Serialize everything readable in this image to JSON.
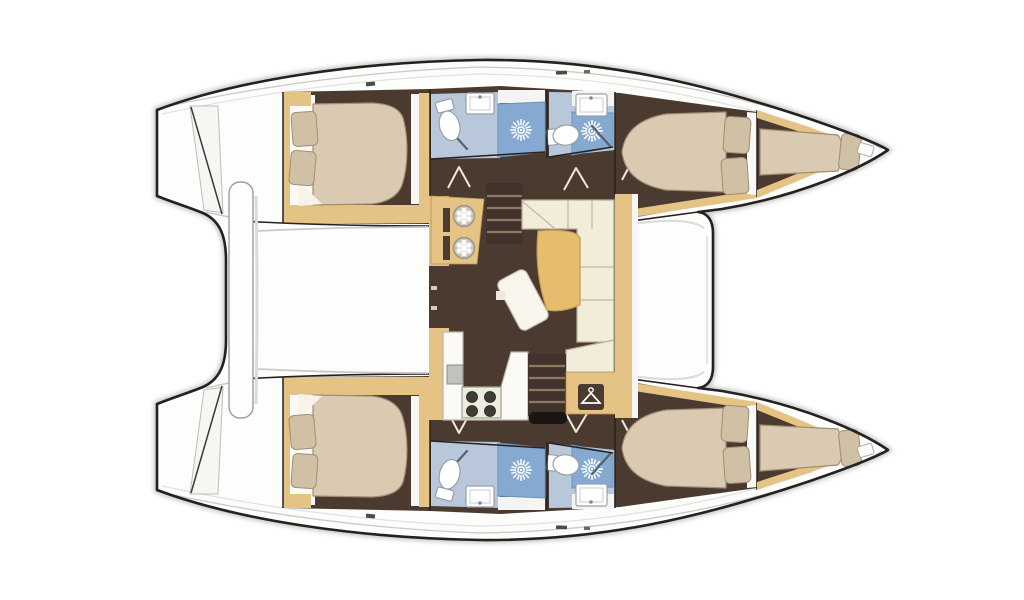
{
  "meta": {
    "title": "Catamaran interior deck plan (top view)"
  },
  "colors": {
    "background": "#ffffff",
    "outline": "#24211e",
    "shadow": "#b7b7b7",
    "deck_white": "#fdfdfc",
    "deck_line": "#c9c9c9",
    "floor_brown": "#4b3a30",
    "steps_brown": "#41332b",
    "tread": "#8d7962",
    "wood": "#e4c384",
    "wood_edge": "#b9924e",
    "bed": "#d9cab1",
    "bed_edge": "#a08f72",
    "pillow": "#cfc0a6",
    "linen_white": "#f7f3e8",
    "sofa": "#f2edda",
    "sofa_edge": "#b7ad92",
    "table_wood": "#e6bc6e",
    "bath_floor": "#b9c7da",
    "shower_blue": "#86a9d1",
    "fixture_white": "#ffffff",
    "fixture_edge": "#96a0ac",
    "stove_body": "#ececdf",
    "burner": "#3f3b35",
    "hatch_black": "#191512"
  },
  "inventory": {
    "hulls": 2,
    "double_cabins": 4,
    "forepeak_berths": 2,
    "bathrooms": 4,
    "showers_with_head_icon": 4,
    "toilets": 4,
    "sinks": 4,
    "saloon": {
      "items": [
        "nav-station with two stools",
        "companionway steps port",
        "companionway steps starboard",
        "L-shaped sofa",
        "curved cockpit table",
        "movable stool",
        "galley counter",
        "4-burner stove",
        "galley sink",
        "wardrobe with hanger icon",
        "aft sliding door"
      ]
    },
    "deck": [
      "aft cockpit bench",
      "twin transom steps",
      "forward crossbeam",
      "bow anchor fittings"
    ]
  }
}
